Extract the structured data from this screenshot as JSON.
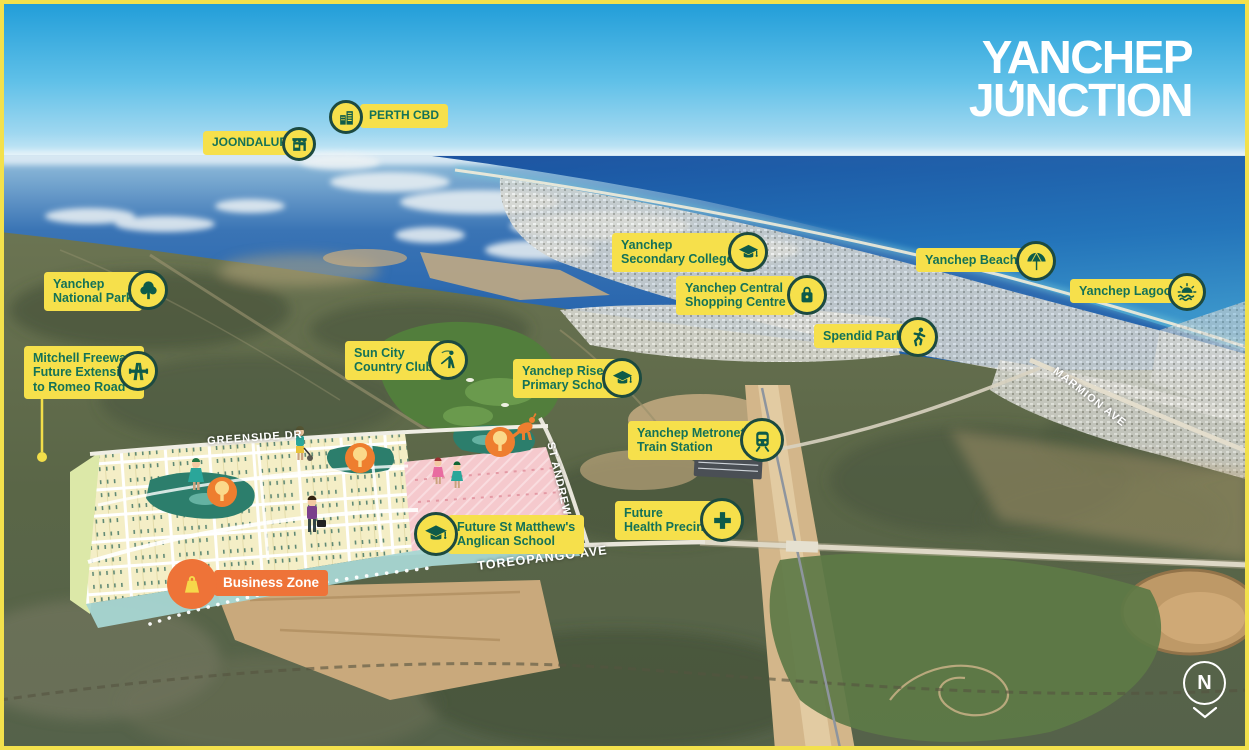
{
  "logo": {
    "line1": "YANCHEP",
    "line2": "JUNCTION"
  },
  "pois": {
    "joondalup": {
      "label": "JOONDALUP",
      "icon": "storefront-icon"
    },
    "perth_cbd": {
      "label": "PERTH CBD",
      "icon": "buildings-icon"
    },
    "national_park": {
      "label": "Yanchep\nNational Park",
      "icon": "tree-icon"
    },
    "mitchell_freeway": {
      "label": "Mitchell Freeway\nFuture Extension\nto Romeo Road",
      "icon": "freeway-icon"
    },
    "sun_city": {
      "label": "Sun City\nCountry Club",
      "icon": "golfer-icon"
    },
    "secondary_college": {
      "label": "Yanchep\nSecondary College",
      "icon": "graduation-cap-icon"
    },
    "shopping_centre": {
      "label": "Yanchep Central\nShopping Centre",
      "icon": "shopping-bag-icon"
    },
    "yanchep_beach": {
      "label": "Yanchep Beach",
      "icon": "beach-umbrella-icon"
    },
    "yanchep_lagoon": {
      "label": "Yanchep Lagoon",
      "icon": "sun-waves-icon"
    },
    "spendid_park": {
      "label": "Spendid Park",
      "icon": "runner-icon"
    },
    "rise_primary": {
      "label": "Yanchep Rise\nPrimary School",
      "icon": "graduation-cap-icon"
    },
    "train_station": {
      "label": "Yanchep Metronet\nTrain Station",
      "icon": "train-icon"
    },
    "health_precinct": {
      "label": "Future\nHealth Precinct",
      "icon": "medical-cross-icon"
    },
    "st_matthews": {
      "label": "Future St Matthew's\nAnglican School",
      "icon": "graduation-cap-icon"
    },
    "business_zone": {
      "label": "Business Zone",
      "icon": "shopping-bag-icon"
    }
  },
  "roads": {
    "greenside": "GREENSIDE DR",
    "st_andrews": "ST ANDREWS DR",
    "toreopango": "TOREOPANGO AVE",
    "marmion": "MARMION AVE"
  },
  "compass": {
    "north_label": "N"
  },
  "colors": {
    "accent_yellow": "#f6e04b",
    "brand_green": "#147257",
    "business_orange": "#ee7338"
  }
}
